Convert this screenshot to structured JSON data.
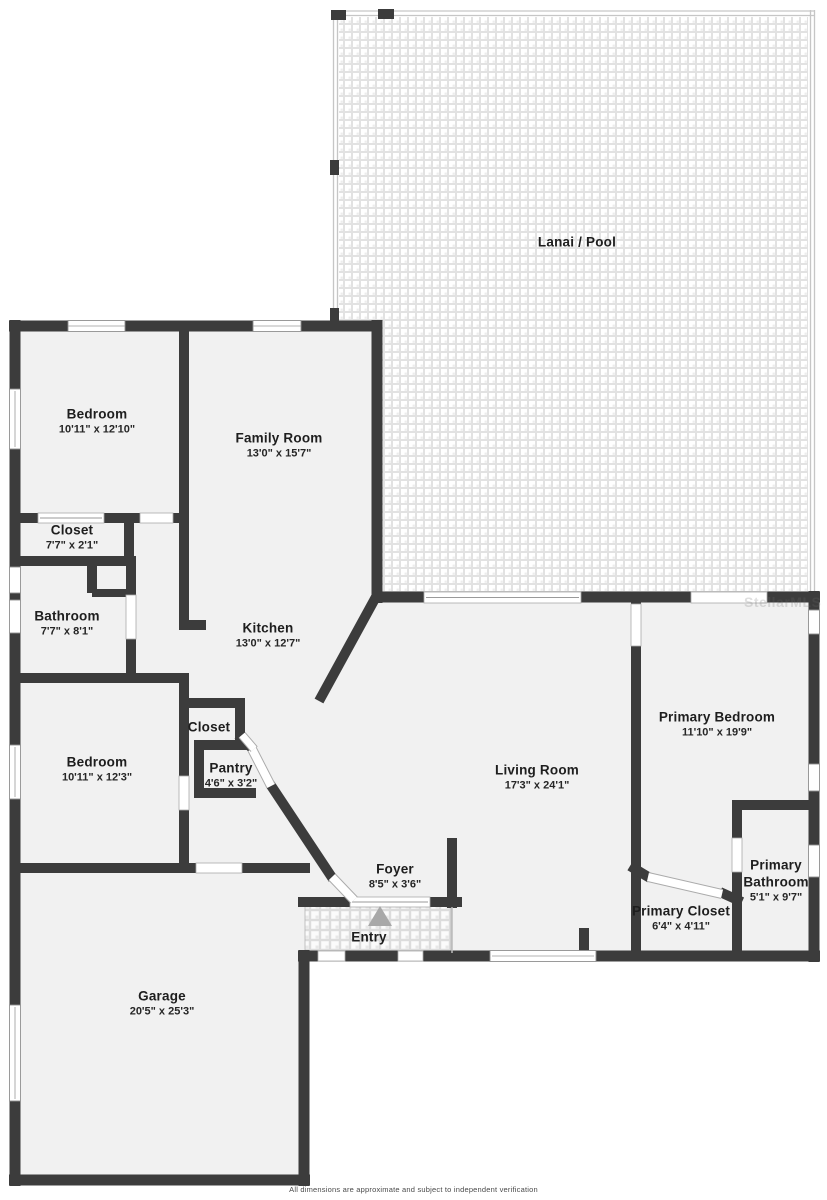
{
  "page": {
    "footer": "All dimensions are approximate and subject to independent verification",
    "watermark": "StellarMLS"
  },
  "colors": {
    "wall": "#3c3c3c",
    "room_fill": "#f1f1f1",
    "lanai_grout": "#e2e2e2",
    "label_text": "#1e1e1e"
  },
  "rooms": [
    {
      "name": "Lanai / Pool",
      "dimensions": ""
    },
    {
      "name": "Bedroom",
      "dimensions": "10'11\" x 12'10\""
    },
    {
      "name": "Family Room",
      "dimensions": "13'0\" x 15'7\""
    },
    {
      "name": "Closet",
      "dimensions": "7'7\" x 2'1\""
    },
    {
      "name": "Bathroom",
      "dimensions": "7'7\" x 8'1\""
    },
    {
      "name": "Kitchen",
      "dimensions": "13'0\" x 12'7\""
    },
    {
      "name": "Closet",
      "dimensions": ""
    },
    {
      "name": "Pantry",
      "dimensions": "4'6\" x 3'2\""
    },
    {
      "name": "Bedroom",
      "dimensions": "10'11\" x 12'3\""
    },
    {
      "name": "Living Room",
      "dimensions": "17'3\" x 24'1\""
    },
    {
      "name": "Primary Bedroom",
      "dimensions": "11'10\" x 19'9\""
    },
    {
      "name": "Primary Closet",
      "dimensions": "6'4\" x 4'11\""
    },
    {
      "name": "Primary Bathroom",
      "dimensions": "5'1\" x 9'7\""
    },
    {
      "name": "Foyer",
      "dimensions": "8'5\" x 3'6\""
    },
    {
      "name": "Entry",
      "dimensions": ""
    },
    {
      "name": "Garage",
      "dimensions": "20'5\" x 25'3\""
    }
  ]
}
